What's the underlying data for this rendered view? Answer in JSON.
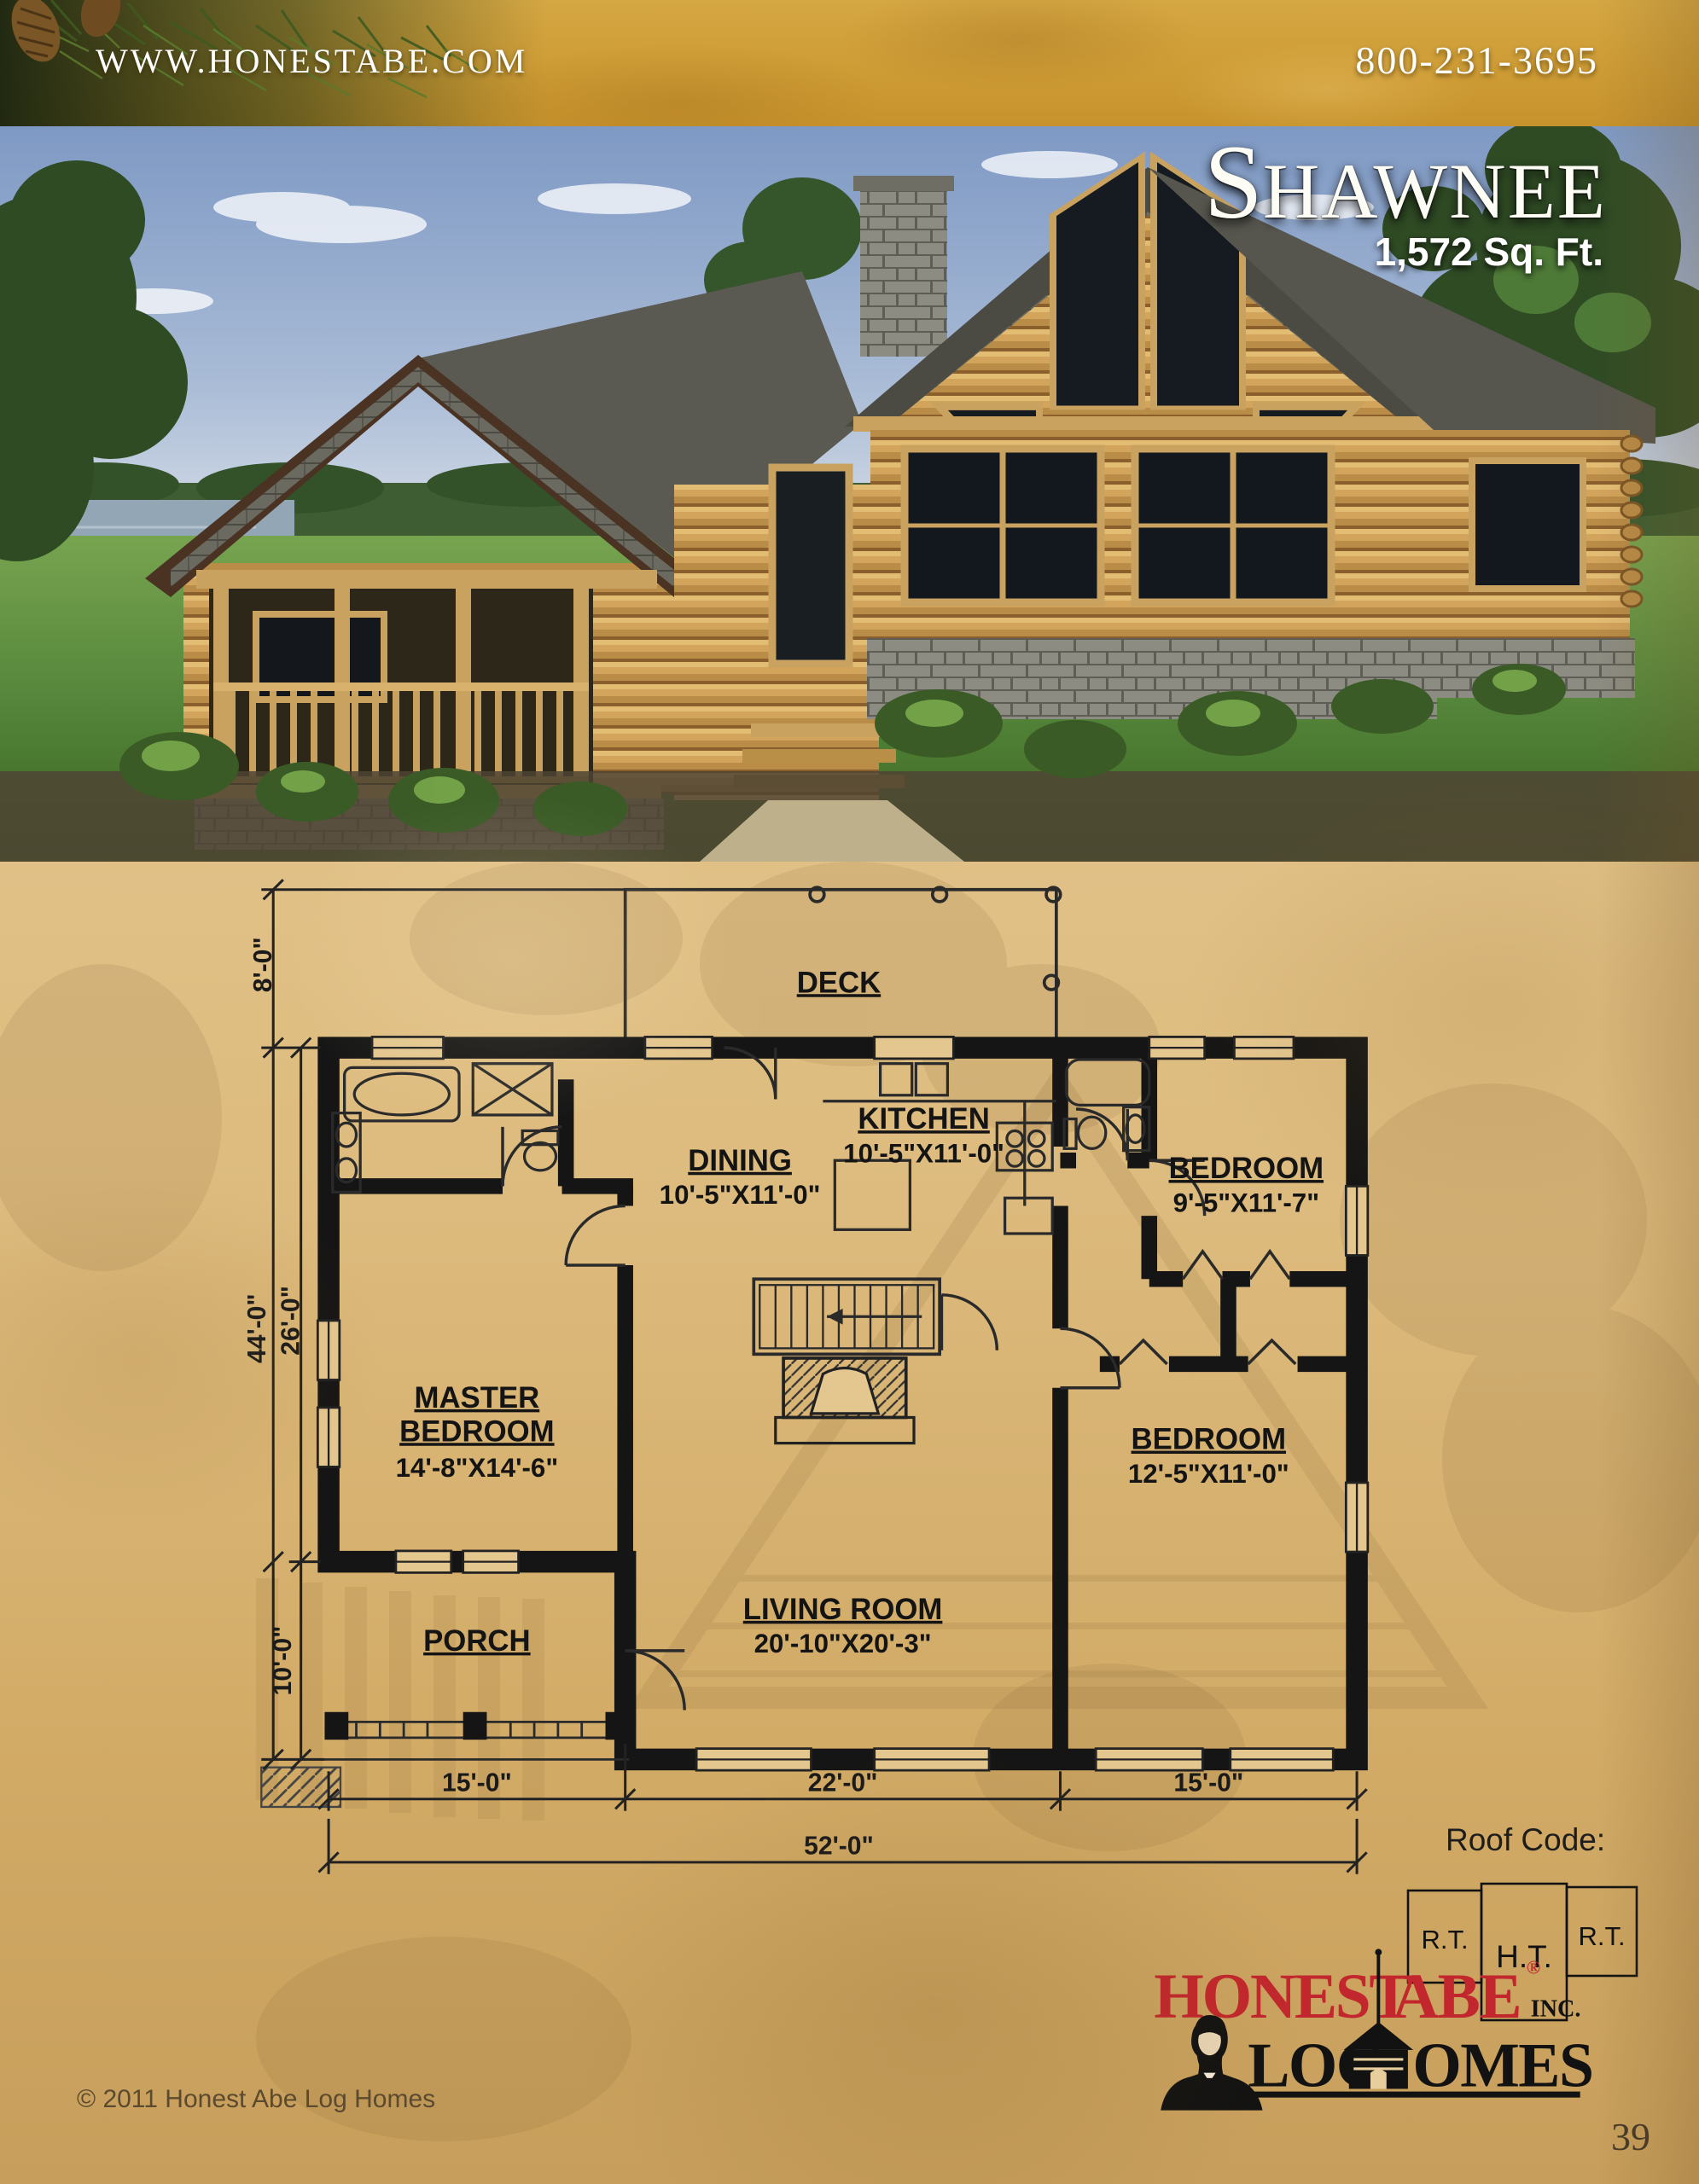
{
  "header": {
    "url": "WWW.HONESTABE.COM",
    "phone": "800-231-3695"
  },
  "hero": {
    "title_initial": "S",
    "title_rest": "HAWNEE",
    "sqft": "1,572 Sq. Ft."
  },
  "plan": {
    "rooms": {
      "deck": {
        "name": "DECK"
      },
      "kitchen": {
        "name": "KITCHEN",
        "dims": "10'-5\"X11'-0\""
      },
      "dining": {
        "name": "DINING",
        "dims": "10'-5\"X11'-0\""
      },
      "bedroom1": {
        "name": "BEDROOM",
        "dims": "9'-5\"X11'-7\""
      },
      "master": {
        "line1": "MASTER",
        "line2": "BEDROOM",
        "dims": "14'-8\"X14'-6\""
      },
      "bedroom2": {
        "name": "BEDROOM",
        "dims": "12'-5\"X11'-0\""
      },
      "living": {
        "name": "LIVING ROOM",
        "dims": "20'-10\"X20'-3\""
      },
      "porch": {
        "name": "PORCH"
      }
    },
    "dims": {
      "deck_depth": "8'-0\"",
      "overall_depth": "44'-0\"",
      "main_depth": "26'-0\"",
      "porch_depth": "10'-0\"",
      "w_left": "15'-0\"",
      "w_center": "22'-0\"",
      "w_right": "15'-0\"",
      "w_total": "52'-0\""
    },
    "roof_code": {
      "label": "Roof Code:",
      "left": "R.T.",
      "center": "H.T.",
      "right": "R.T."
    }
  },
  "logo": {
    "honest": "HONEST",
    "abe": "ABE",
    "registered": "®",
    "inc": "INC.",
    "log": "LOG",
    "omes": "OMES"
  },
  "footer": {
    "copyright": "© 2011 Honest Abe Log Homes",
    "page_number": "39"
  },
  "colors": {
    "logo_red": "#C2272D",
    "header_gold": "#CE9C35",
    "parchment": "#DDBB7E",
    "plan_ink": "#141414",
    "sky": "#8FA7CB",
    "grass": "#55863B",
    "roof_gray": "#5E5D53",
    "log_tan": "#D2A45C"
  }
}
